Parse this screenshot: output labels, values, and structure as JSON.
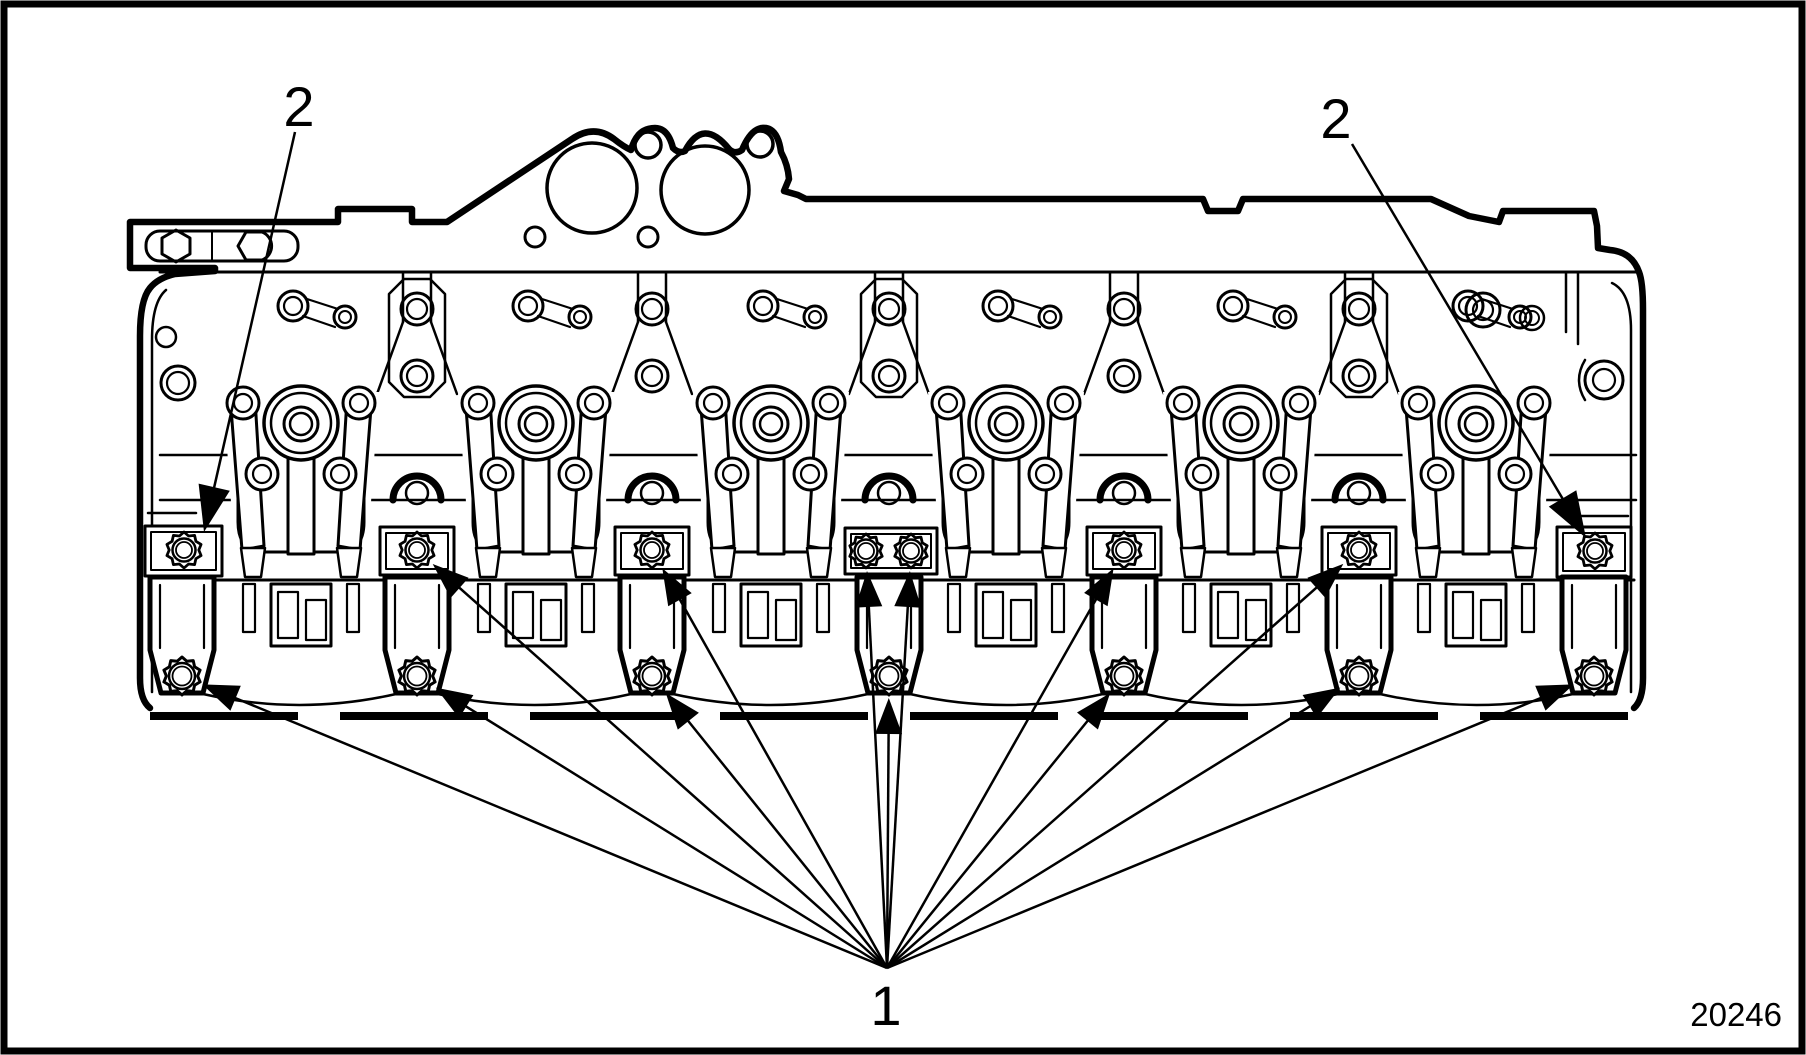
{
  "figure": {
    "number": "20246"
  },
  "callouts": {
    "item1": {
      "label": "1",
      "label_x": 886,
      "label_y": 1025,
      "vertex": [
        887,
        968
      ],
      "targets": [
        {
          "x": 182,
          "y": 676,
          "r": 19
        },
        {
          "x": 417,
          "y": 676,
          "r": 19
        },
        {
          "x": 652,
          "y": 676,
          "r": 19
        },
        {
          "x": 889,
          "y": 676,
          "r": 19
        },
        {
          "x": 1124,
          "y": 676,
          "r": 19
        },
        {
          "x": 1359,
          "y": 676,
          "r": 19
        },
        {
          "x": 1594,
          "y": 676,
          "r": 19
        },
        {
          "x": 417,
          "y": 550,
          "r": 18
        },
        {
          "x": 652,
          "y": 550,
          "r": 18
        },
        {
          "x": 866,
          "y": 551,
          "r": 17
        },
        {
          "x": 911,
          "y": 551,
          "r": 17
        },
        {
          "x": 1124,
          "y": 550,
          "r": 18
        },
        {
          "x": 1359,
          "y": 550,
          "r": 18
        }
      ]
    },
    "item2": {
      "label": "2",
      "instances": [
        {
          "label": "2",
          "label_x": 299,
          "label_y": 126,
          "from": [
            295,
            132
          ],
          "apex": [
            204,
            532
          ]
        },
        {
          "label": "2",
          "label_x": 1336,
          "label_y": 138,
          "from": [
            1352,
            144
          ],
          "apex": [
            1586,
            538
          ]
        }
      ]
    }
  }
}
